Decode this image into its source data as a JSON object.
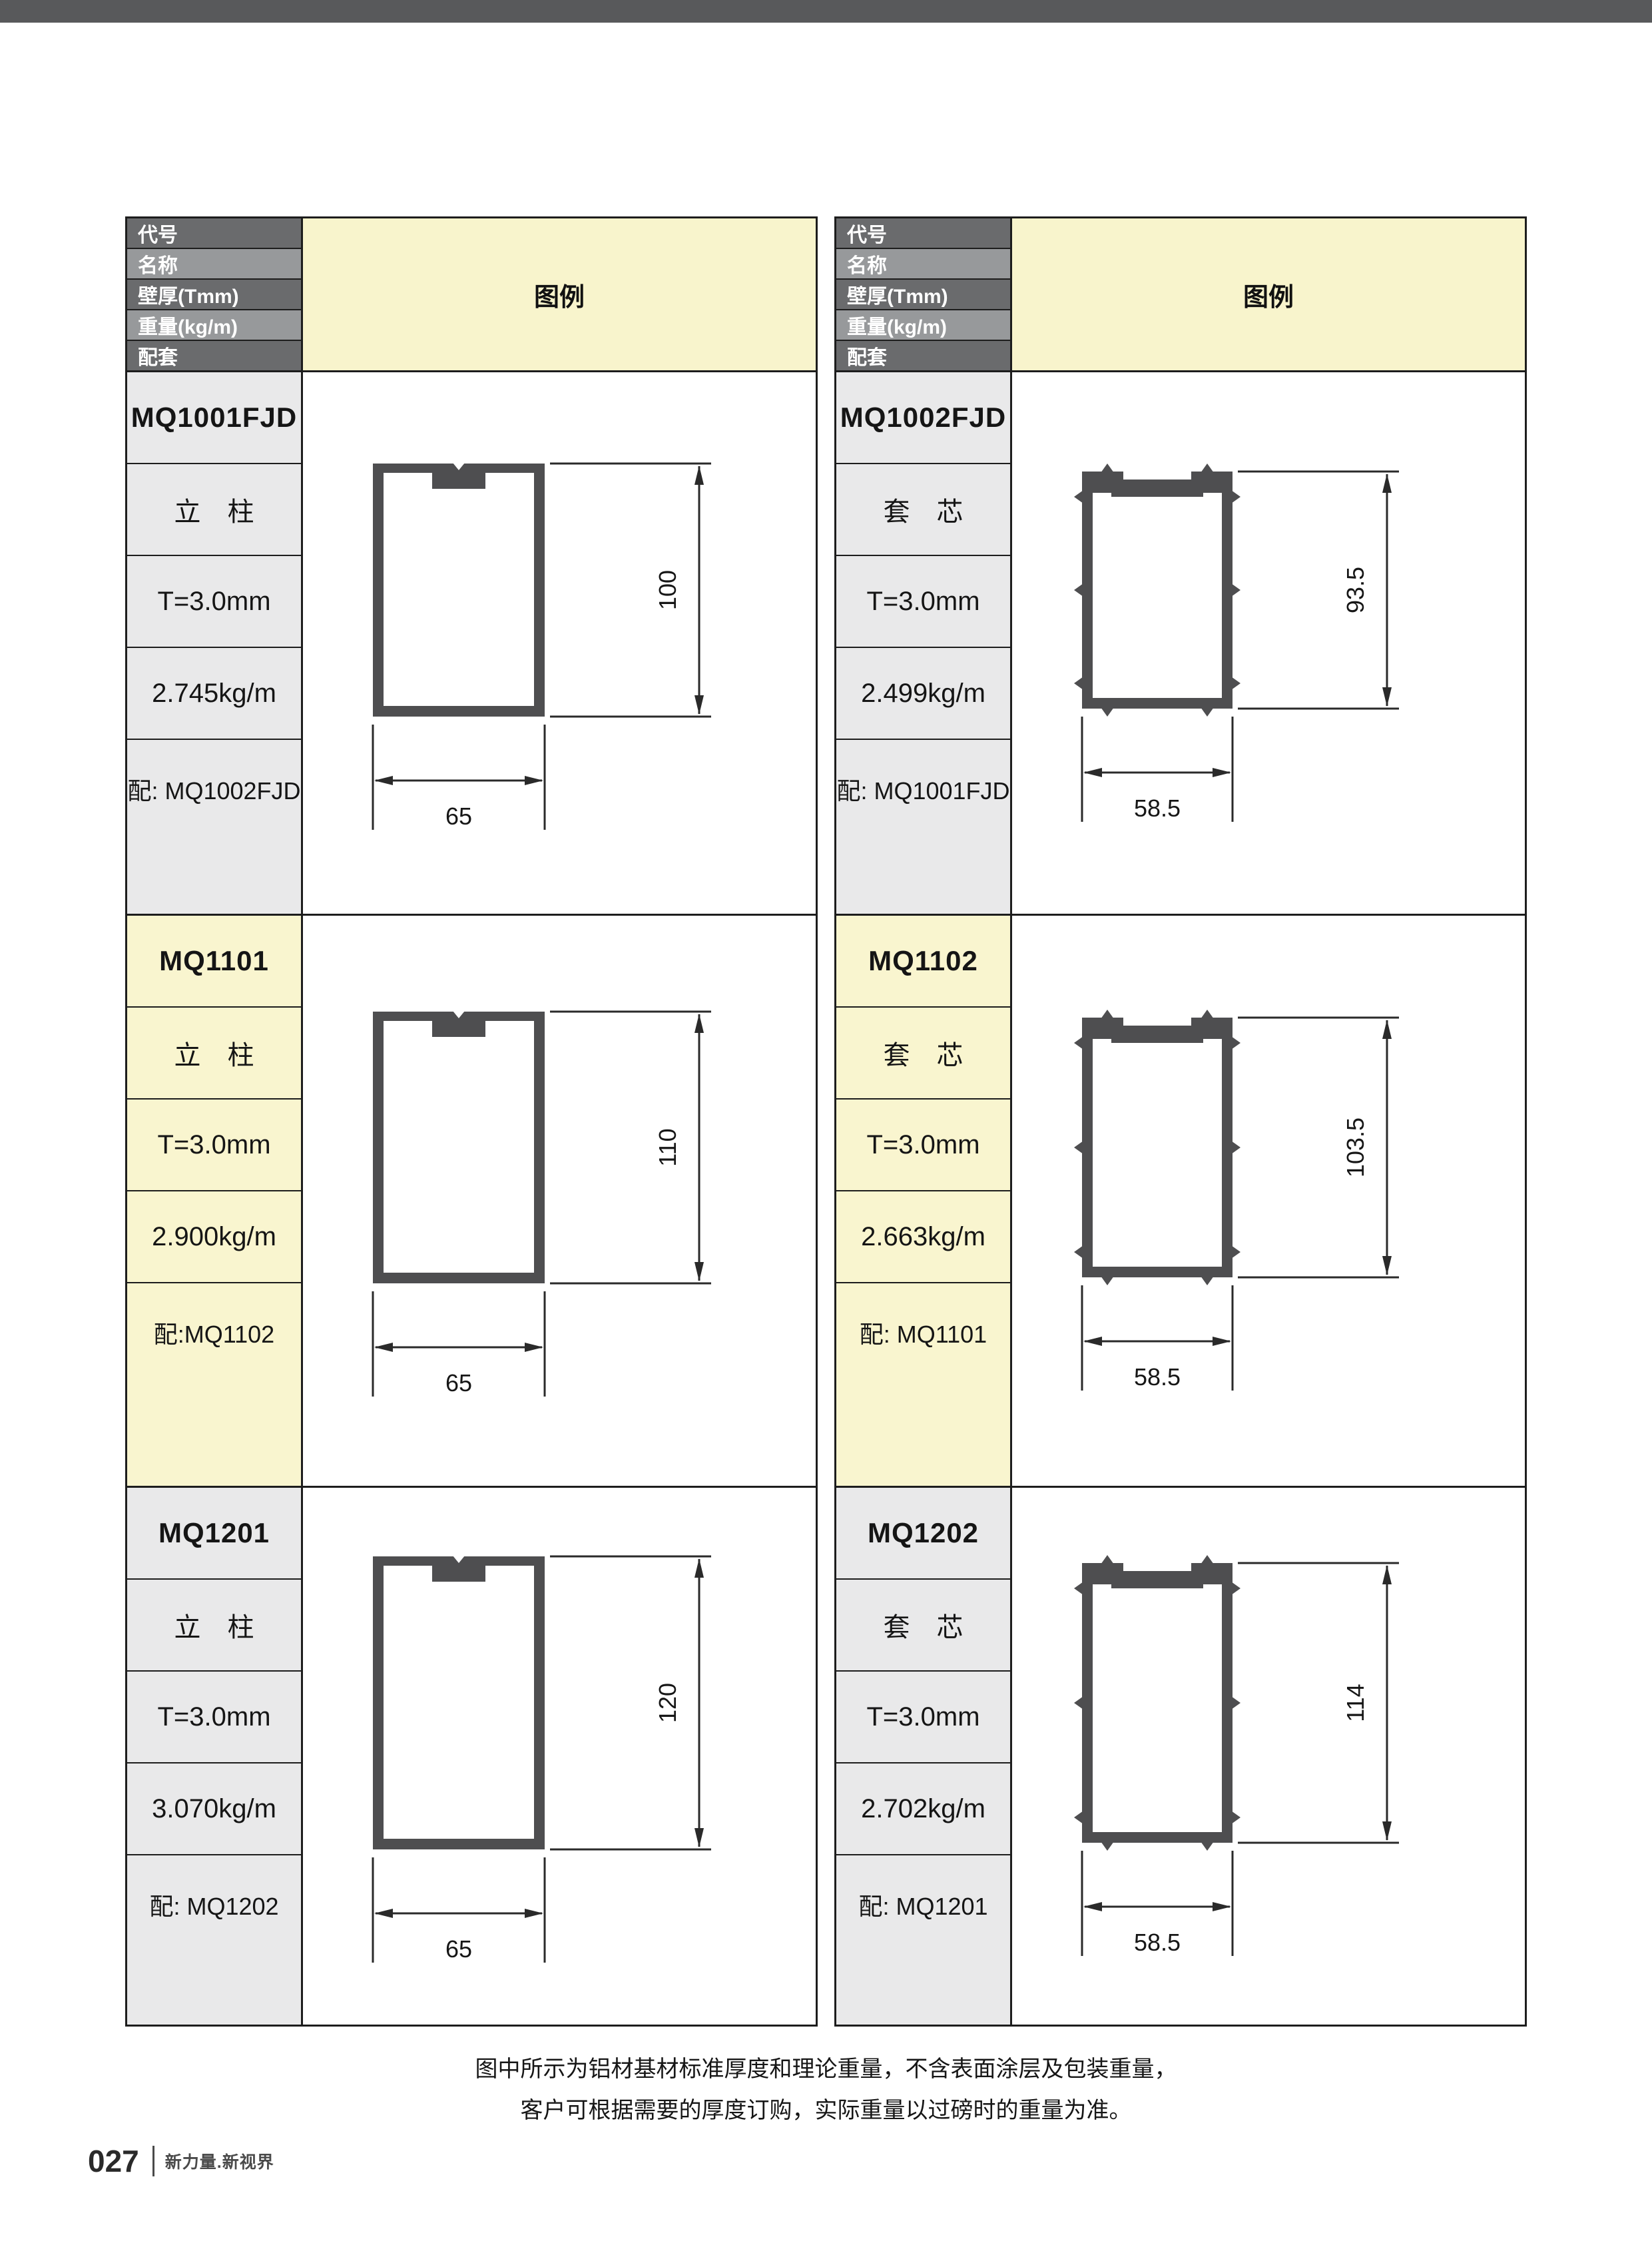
{
  "header": {
    "rows": [
      "代号",
      "名称",
      "壁厚(Tmm)",
      "重量(kg/m)",
      "配套"
    ],
    "legend": "图例"
  },
  "columns": {
    "left": [
      {
        "code": "MQ1001FJD",
        "name": "立　柱",
        "thickness": "T=3.0mm",
        "weight": "2.745kg/m",
        "match": "配: MQ1002FJD",
        "width": "65",
        "height": "100"
      },
      {
        "code": "MQ1101",
        "name": "立　柱",
        "thickness": "T=3.0mm",
        "weight": "2.900kg/m",
        "match": "配:MQ1102",
        "width": "65",
        "height": "110"
      },
      {
        "code": "MQ1201",
        "name": "立　柱",
        "thickness": "T=3.0mm",
        "weight": "3.070kg/m",
        "match": "配: MQ1202",
        "width": "65",
        "height": "120"
      }
    ],
    "right": [
      {
        "code": "MQ1002FJD",
        "name": "套　芯",
        "thickness": "T=3.0mm",
        "weight": "2.499kg/m",
        "match": "配: MQ1001FJD",
        "width": "58.5",
        "height": "93.5"
      },
      {
        "code": "MQ1102",
        "name": "套　芯",
        "thickness": "T=3.0mm",
        "weight": "2.663kg/m",
        "match": "配: MQ1101",
        "width": "58.5",
        "height": "103.5"
      },
      {
        "code": "MQ1202",
        "name": "套　芯",
        "thickness": "T=3.0mm",
        "weight": "2.702kg/m",
        "match": "配: MQ1201",
        "width": "58.5",
        "height": "114"
      }
    ]
  },
  "note": {
    "line1": "图中所示为铝材基材标准厚度和理论重量，不含表面涂层及包装重量，",
    "line2": "客户可根据需要的厚度订购，实际重量以过磅时的重量为准。"
  },
  "footer": {
    "page_number": "027",
    "brand": "新力量.新视界"
  },
  "colors": {
    "top_bar": "#58595b",
    "header_dark": "#6a6b6d",
    "header_light": "#97999b",
    "legend_yellow": "#f8f4cc",
    "row_highlight_yellow": "#f9f5cf",
    "label_gray": "#e9e9ea",
    "profile_fill": "#4e4e50"
  }
}
